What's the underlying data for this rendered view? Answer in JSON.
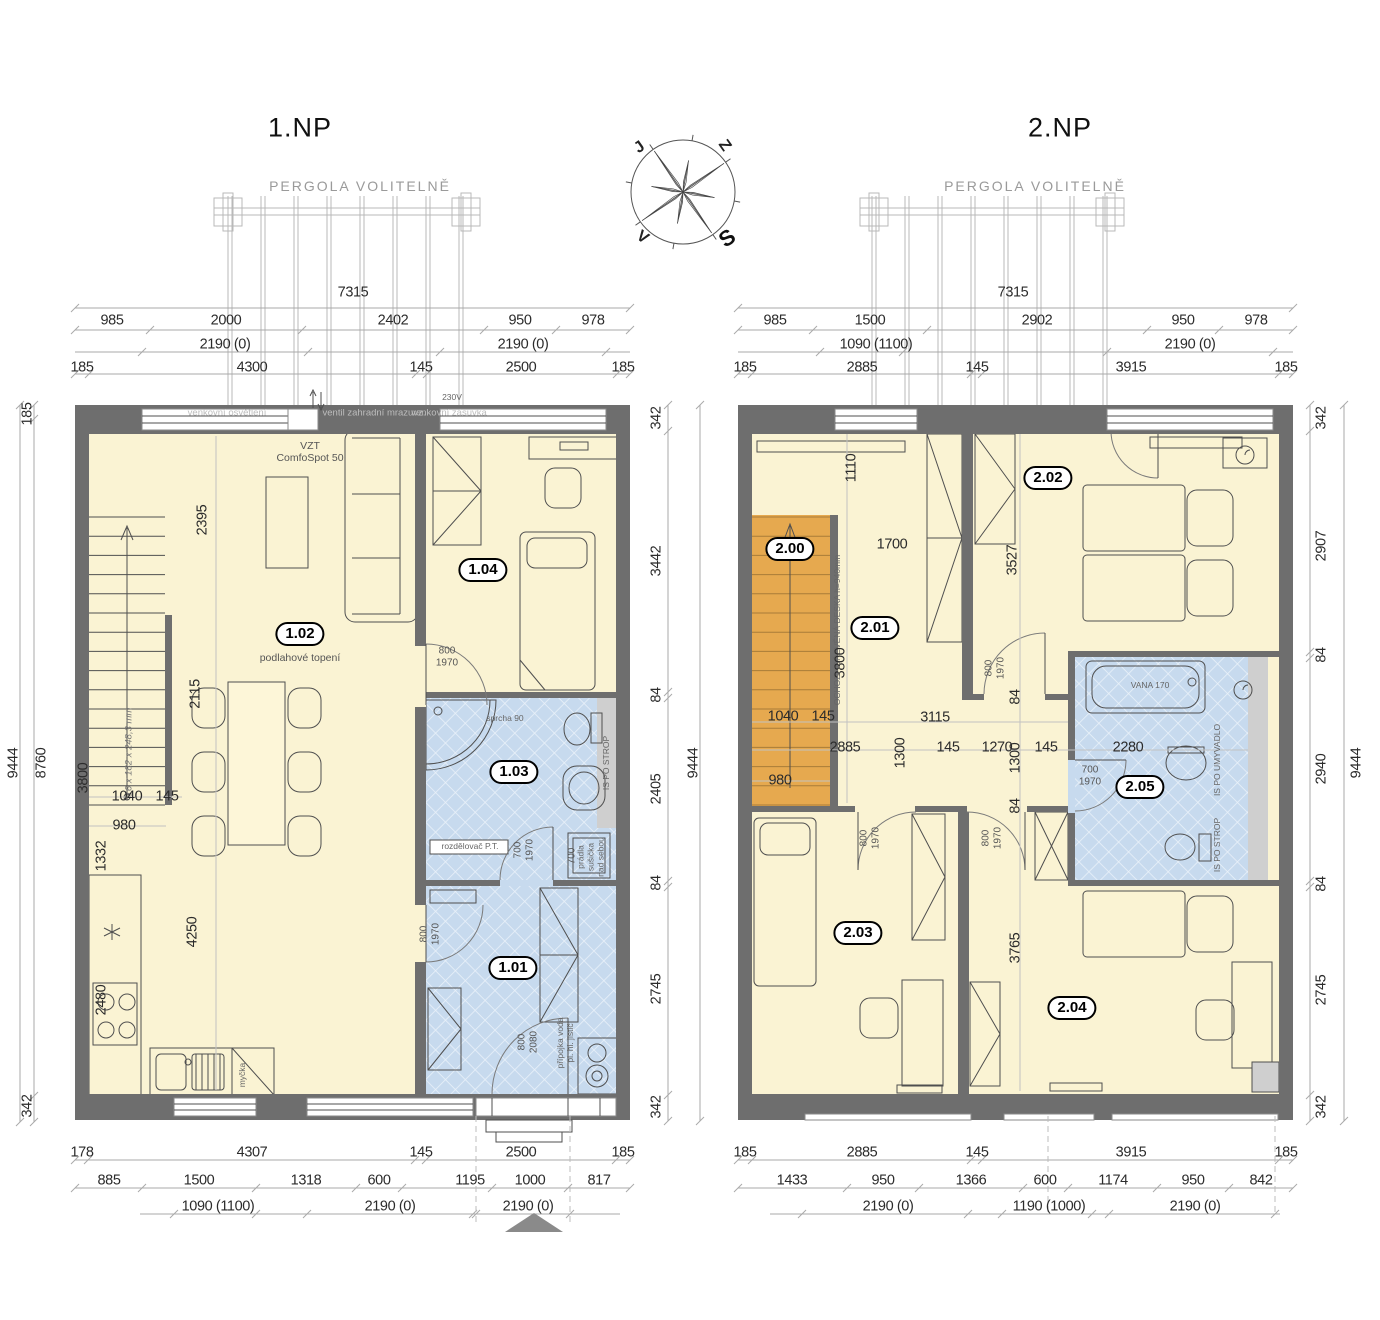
{
  "document": {
    "type": "floor-plan-drawing",
    "floors": [
      "1.NP",
      "2.NP"
    ]
  },
  "colors": {
    "wall": "#6e6e6e",
    "floor": "#faf3d3",
    "bath": "#c7daee",
    "stairs": "#e6a94f",
    "accent": "#000000"
  },
  "compass": {
    "north": "S",
    "south": "J",
    "east": "V",
    "west": "Z"
  },
  "rooms": [
    "1.01",
    "1.02",
    "1.03",
    "1.04",
    "2.00",
    "2.01",
    "2.02",
    "2.03",
    "2.04",
    "2.05"
  ],
  "labels": [
    {
      "t": "1.NP",
      "x": 300,
      "y": 128,
      "c": "title",
      "n": "plan-title-1np"
    },
    {
      "t": "2.NP",
      "x": 1060,
      "y": 128,
      "c": "title",
      "n": "plan-title-2np"
    },
    {
      "t": "PERGOLA VOLITELNĚ",
      "x": 360,
      "y": 186,
      "c": "perg",
      "n": "pergola-label-left"
    },
    {
      "t": "PERGOLA VOLITELNĚ",
      "x": 1035,
      "y": 186,
      "c": "perg",
      "n": "pergola-label-right"
    },
    {
      "t": "7315",
      "x": 353,
      "y": 293
    },
    {
      "t": "985",
      "x": 112,
      "y": 321
    },
    {
      "t": "2000",
      "x": 226,
      "y": 321
    },
    {
      "t": "2402",
      "x": 393,
      "y": 321
    },
    {
      "t": "950",
      "x": 520,
      "y": 321
    },
    {
      "t": "978",
      "x": 593,
      "y": 321
    },
    {
      "t": "2190 (0)",
      "x": 225,
      "y": 345
    },
    {
      "t": "2190 (0)",
      "x": 523,
      "y": 345
    },
    {
      "t": "185",
      "x": 82,
      "y": 368
    },
    {
      "t": "4300",
      "x": 252,
      "y": 368
    },
    {
      "t": "145",
      "x": 421,
      "y": 368
    },
    {
      "t": "2500",
      "x": 521,
      "y": 368
    },
    {
      "t": "185",
      "x": 623,
      "y": 368
    },
    {
      "t": "185",
      "x": 28,
      "y": 414,
      "r": -90
    },
    {
      "t": "9444",
      "x": 14,
      "y": 763,
      "r": -90
    },
    {
      "t": "8760",
      "x": 42,
      "y": 763,
      "r": -90
    },
    {
      "t": "342",
      "x": 28,
      "y": 1106,
      "r": -90
    },
    {
      "t": "342",
      "x": 657,
      "y": 418,
      "r": -90
    },
    {
      "t": "3442",
      "x": 657,
      "y": 561,
      "r": -90
    },
    {
      "t": "84",
      "x": 657,
      "y": 695,
      "r": -90
    },
    {
      "t": "2405",
      "x": 657,
      "y": 789,
      "r": -90
    },
    {
      "t": "84",
      "x": 657,
      "y": 883,
      "r": -90
    },
    {
      "t": "2745",
      "x": 657,
      "y": 989,
      "r": -90
    },
    {
      "t": "342",
      "x": 657,
      "y": 1107,
      "r": -90
    },
    {
      "t": "9444",
      "x": 694,
      "y": 763,
      "r": -90
    },
    {
      "t": "178",
      "x": 82,
      "y": 1153
    },
    {
      "t": "4307",
      "x": 252,
      "y": 1153
    },
    {
      "t": "145",
      "x": 421,
      "y": 1153
    },
    {
      "t": "2500",
      "x": 521,
      "y": 1153
    },
    {
      "t": "185",
      "x": 623,
      "y": 1153
    },
    {
      "t": "885",
      "x": 109,
      "y": 1181
    },
    {
      "t": "1500",
      "x": 199,
      "y": 1181
    },
    {
      "t": "1318",
      "x": 306,
      "y": 1181
    },
    {
      "t": "600",
      "x": 379,
      "y": 1181
    },
    {
      "t": "1195",
      "x": 470,
      "y": 1181
    },
    {
      "t": "1000",
      "x": 530,
      "y": 1181
    },
    {
      "t": "817",
      "x": 599,
      "y": 1181
    },
    {
      "t": "1090 (1100)",
      "x": 218,
      "y": 1207
    },
    {
      "t": "2190 (0)",
      "x": 390,
      "y": 1207
    },
    {
      "t": "2190 (0)",
      "x": 528,
      "y": 1207
    },
    {
      "t": "2395",
      "x": 203,
      "y": 520,
      "r": -90
    },
    {
      "t": "3800",
      "x": 84,
      "y": 778,
      "r": -90
    },
    {
      "t": "16 x 182 x 248,3 mm",
      "x": 130,
      "y": 752,
      "c": "it",
      "r": -90
    },
    {
      "t": "2115",
      "x": 196,
      "y": 694,
      "r": -90
    },
    {
      "t": "1040",
      "x": 127,
      "y": 797
    },
    {
      "t": "145",
      "x": 167,
      "y": 797
    },
    {
      "t": "980",
      "x": 124,
      "y": 826
    },
    {
      "t": "1332",
      "x": 102,
      "y": 856,
      "r": -90
    },
    {
      "t": "4250",
      "x": 193,
      "y": 932,
      "r": -90
    },
    {
      "t": "2480",
      "x": 102,
      "y": 1000,
      "r": -90
    },
    {
      "t": "VZT\nComfoSpot 50",
      "x": 310,
      "y": 452,
      "c": "ann",
      "n": "vzt-note"
    },
    {
      "t": "venkovní osvětlení",
      "x": 227,
      "y": 414,
      "c": "wall"
    },
    {
      "t": "ventil zahradní mrazuvz.",
      "x": 374,
      "y": 414,
      "c": "wall"
    },
    {
      "t": "venkovní zásuvka",
      "x": 449,
      "y": 414,
      "c": "wall"
    },
    {
      "t": "230V",
      "x": 452,
      "y": 398,
      "c": "tiny"
    },
    {
      "t": "1.02",
      "x": 300,
      "y": 634,
      "c": "badge",
      "n": "room-label-1-02"
    },
    {
      "t": "podlahové topení",
      "x": 300,
      "y": 658,
      "c": "ann"
    },
    {
      "t": "1.04",
      "x": 483,
      "y": 570,
      "c": "badge",
      "n": "room-label-1-04"
    },
    {
      "t": "1.03",
      "x": 514,
      "y": 772,
      "c": "badge",
      "n": "room-label-1-03"
    },
    {
      "t": "1.01",
      "x": 513,
      "y": 968,
      "c": "badge",
      "n": "room-label-1-01"
    },
    {
      "t": "800\n1970",
      "x": 447,
      "y": 657,
      "c": "sm"
    },
    {
      "t": "700\n1970",
      "x": 524,
      "y": 850,
      "c": "sm",
      "r": -90
    },
    {
      "t": "800\n1970",
      "x": 430,
      "y": 934,
      "c": "sm",
      "r": -90
    },
    {
      "t": "800\n2080",
      "x": 528,
      "y": 1042,
      "c": "sm",
      "r": -90
    },
    {
      "t": "sprcha 90",
      "x": 505,
      "y": 719,
      "c": "tiny"
    },
    {
      "t": "rozdělovač P.T.",
      "x": 470,
      "y": 847,
      "c": "tiny"
    },
    {
      "t": "IS PO STROP",
      "x": 607,
      "y": 763,
      "c": "tiny",
      "r": -90
    },
    {
      "t": "prádla\nsušička\nnad sebou",
      "x": 591,
      "y": 857,
      "c": "tiny",
      "r": -90
    },
    {
      "t": "700",
      "x": 572,
      "y": 856,
      "c": "sm",
      "r": -90
    },
    {
      "t": "myčka",
      "x": 243,
      "y": 1075,
      "c": "tiny",
      "r": -90
    },
    {
      "t": "přípojka voda\npl. hl. jistič",
      "x": 566,
      "y": 1043,
      "c": "tiny",
      "r": -90
    },
    {
      "t": "7315",
      "x": 1013,
      "y": 293
    },
    {
      "t": "985",
      "x": 775,
      "y": 321
    },
    {
      "t": "1500",
      "x": 870,
      "y": 321
    },
    {
      "t": "2902",
      "x": 1037,
      "y": 321
    },
    {
      "t": "950",
      "x": 1183,
      "y": 321
    },
    {
      "t": "978",
      "x": 1256,
      "y": 321
    },
    {
      "t": "1090 (1100)",
      "x": 876,
      "y": 345
    },
    {
      "t": "2190 (0)",
      "x": 1190,
      "y": 345
    },
    {
      "t": "185",
      "x": 745,
      "y": 368
    },
    {
      "t": "2885",
      "x": 862,
      "y": 368
    },
    {
      "t": "145",
      "x": 977,
      "y": 368
    },
    {
      "t": "3915",
      "x": 1131,
      "y": 368
    },
    {
      "t": "185",
      "x": 1286,
      "y": 368
    },
    {
      "t": "342",
      "x": 1322,
      "y": 418,
      "r": -90
    },
    {
      "t": "2907",
      "x": 1322,
      "y": 546,
      "r": -90
    },
    {
      "t": "84",
      "x": 1322,
      "y": 655,
      "r": -90
    },
    {
      "t": "2940",
      "x": 1322,
      "y": 769,
      "r": -90
    },
    {
      "t": "84",
      "x": 1322,
      "y": 884,
      "r": -90
    },
    {
      "t": "2745",
      "x": 1322,
      "y": 990,
      "r": -90
    },
    {
      "t": "342",
      "x": 1322,
      "y": 1107,
      "r": -90
    },
    {
      "t": "9444",
      "x": 1357,
      "y": 763,
      "r": -90
    },
    {
      "t": "185",
      "x": 745,
      "y": 1153
    },
    {
      "t": "2885",
      "x": 862,
      "y": 1153
    },
    {
      "t": "145",
      "x": 977,
      "y": 1153
    },
    {
      "t": "3915",
      "x": 1131,
      "y": 1153
    },
    {
      "t": "185",
      "x": 1286,
      "y": 1153
    },
    {
      "t": "1433",
      "x": 792,
      "y": 1181
    },
    {
      "t": "950",
      "x": 883,
      "y": 1181
    },
    {
      "t": "1366",
      "x": 971,
      "y": 1181
    },
    {
      "t": "600",
      "x": 1045,
      "y": 1181
    },
    {
      "t": "1174",
      "x": 1113,
      "y": 1181
    },
    {
      "t": "950",
      "x": 1193,
      "y": 1181
    },
    {
      "t": "842",
      "x": 1261,
      "y": 1181
    },
    {
      "t": "2190 (0)",
      "x": 888,
      "y": 1207
    },
    {
      "t": "1190 (1000)",
      "x": 1049,
      "y": 1207
    },
    {
      "t": "2190 (0)",
      "x": 1195,
      "y": 1207
    },
    {
      "t": "2.00",
      "x": 790,
      "y": 549,
      "c": "badge",
      "n": "room-label-2-00"
    },
    {
      "t": "2.01",
      "x": 875,
      "y": 628,
      "c": "badge",
      "n": "room-label-2-01"
    },
    {
      "t": "2.02",
      "x": 1048,
      "y": 478,
      "c": "badge",
      "n": "room-label-2-02"
    },
    {
      "t": "2.03",
      "x": 858,
      "y": 933,
      "c": "badge",
      "n": "room-label-2-03"
    },
    {
      "t": "2.04",
      "x": 1072,
      "y": 1008,
      "c": "badge",
      "n": "room-label-2-04"
    },
    {
      "t": "2.05",
      "x": 1140,
      "y": 787,
      "c": "badge",
      "n": "room-label-2-05"
    },
    {
      "t": "OCHOZ - DŘEVĚNÁ DESKA h=940mm",
      "x": 838,
      "y": 630,
      "c": "tiny",
      "r": -90
    },
    {
      "t": "1110",
      "x": 852,
      "y": 468,
      "r": -90
    },
    {
      "t": "1700",
      "x": 892,
      "y": 545
    },
    {
      "t": "3527",
      "x": 1013,
      "y": 560,
      "r": -90
    },
    {
      "t": "3800",
      "x": 841,
      "y": 663,
      "r": -90
    },
    {
      "t": "3115",
      "x": 935,
      "y": 718
    },
    {
      "t": "1040",
      "x": 783,
      "y": 717
    },
    {
      "t": "145",
      "x": 823,
      "y": 717
    },
    {
      "t": "2885",
      "x": 845,
      "y": 748
    },
    {
      "t": "1300",
      "x": 901,
      "y": 753,
      "r": -90
    },
    {
      "t": "145",
      "x": 948,
      "y": 748
    },
    {
      "t": "1270",
      "x": 997,
      "y": 748
    },
    {
      "t": "1300",
      "x": 1016,
      "y": 758,
      "r": -90
    },
    {
      "t": "145",
      "x": 1046,
      "y": 748
    },
    {
      "t": "2280",
      "x": 1128,
      "y": 748
    },
    {
      "t": "980",
      "x": 780,
      "y": 781
    },
    {
      "t": "84",
      "x": 1016,
      "y": 697,
      "r": -90
    },
    {
      "t": "84",
      "x": 1016,
      "y": 806,
      "r": -90
    },
    {
      "t": "3765",
      "x": 1016,
      "y": 948,
      "r": -90
    },
    {
      "t": "800\n1970",
      "x": 995,
      "y": 668,
      "c": "sm",
      "r": -90
    },
    {
      "t": "700\n1970",
      "x": 1090,
      "y": 776,
      "c": "sm"
    },
    {
      "t": "800\n1970",
      "x": 870,
      "y": 838,
      "c": "sm",
      "r": -90
    },
    {
      "t": "800\n1970",
      "x": 992,
      "y": 838,
      "c": "sm",
      "r": -90
    },
    {
      "t": "VANA 170",
      "x": 1150,
      "y": 686,
      "c": "tiny"
    },
    {
      "t": "IS PO UMYVADLO",
      "x": 1218,
      "y": 760,
      "c": "tiny",
      "r": -90
    },
    {
      "t": "IS PO STROP",
      "x": 1218,
      "y": 845,
      "c": "tiny",
      "r": -90
    },
    {
      "t": "Z",
      "x": 724,
      "y": 146,
      "c": "comp",
      "r": 55,
      "n": "compass-west"
    },
    {
      "t": "J",
      "x": 640,
      "y": 148,
      "c": "comp",
      "r": -35,
      "n": "compass-south"
    },
    {
      "t": "V",
      "x": 642,
      "y": 238,
      "c": "comp",
      "r": 35,
      "n": "compass-east"
    },
    {
      "t": "S",
      "x": 727,
      "y": 238,
      "c": "compb",
      "r": -35,
      "n": "compass-north"
    }
  ]
}
